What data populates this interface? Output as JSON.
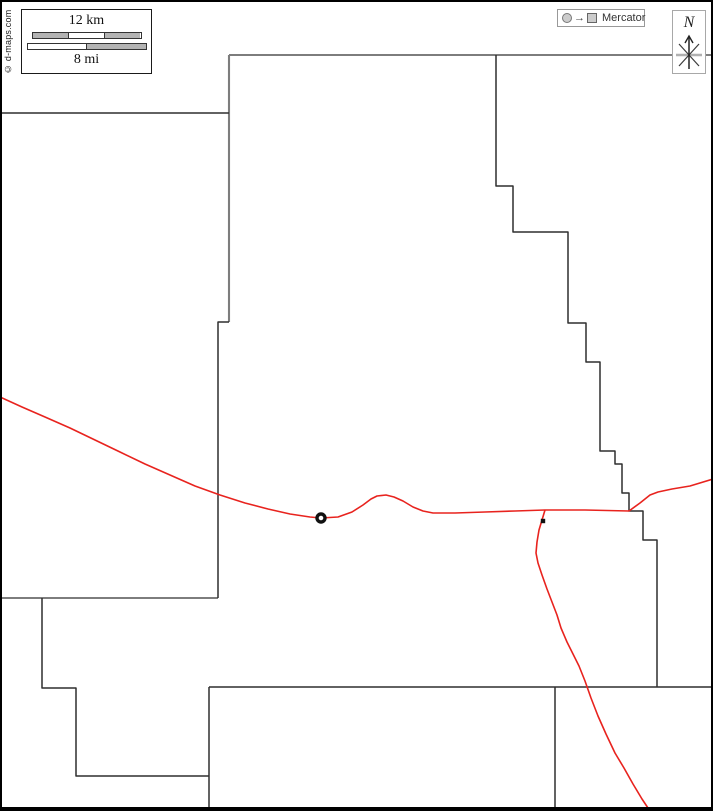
{
  "copyright": {
    "text": "© d-maps.com"
  },
  "scale_box": {
    "km_label": "12 km",
    "mi_label": "8 mi",
    "km_segments": [
      "#b3b3b3",
      "#ffffff",
      "#b3b3b3"
    ],
    "mi_segments": [
      "#ffffff",
      "#b3b3b3"
    ]
  },
  "projection": {
    "label": "Mercator",
    "icons": [
      "sphere-circle-icon",
      "arrow-right-icon",
      "flat-map-square-icon"
    ],
    "arrow_glyph": "→"
  },
  "compass": {
    "north_label": "N",
    "icon": "compass-star-icon"
  },
  "colors": {
    "boundary_dark": "#2f2f2f",
    "boundary_gray": "#7d7d7d",
    "road": "#e8231e",
    "marker": "#111111",
    "frame": "#000000"
  },
  "map": {
    "boundaries_gray": [
      [
        [
          229,
          55
        ],
        [
          713,
          55
        ]
      ],
      [
        [
          229,
          55
        ],
        [
          229,
          322
        ]
      ],
      [
        [
          0,
          598
        ],
        [
          218,
          598
        ]
      ]
    ],
    "boundaries_dark": [
      [
        [
          0,
          113
        ],
        [
          229,
          113
        ]
      ],
      [
        [
          229,
          322
        ],
        [
          218,
          322
        ],
        [
          218,
          598
        ]
      ],
      [
        [
          42,
          598
        ],
        [
          42,
          688
        ],
        [
          76,
          688
        ],
        [
          76,
          776
        ],
        [
          209,
          776
        ]
      ],
      [
        [
          209,
          687
        ],
        [
          209,
          807
        ]
      ],
      [
        [
          209,
          687
        ],
        [
          713,
          687
        ]
      ],
      [
        [
          555,
          687
        ],
        [
          555,
          807
        ]
      ],
      [
        [
          496,
          55
        ],
        [
          496,
          186
        ],
        [
          513,
          186
        ],
        [
          513,
          232
        ],
        [
          568,
          232
        ],
        [
          568,
          323
        ],
        [
          586,
          323
        ],
        [
          586,
          362
        ],
        [
          600,
          362
        ],
        [
          600,
          451
        ],
        [
          615,
          451
        ],
        [
          615,
          464
        ],
        [
          622,
          464
        ],
        [
          622,
          493
        ],
        [
          629,
          493
        ],
        [
          629,
          511
        ],
        [
          643,
          511
        ],
        [
          643,
          540
        ],
        [
          657,
          540
        ],
        [
          657,
          687
        ]
      ]
    ],
    "roads": [
      [
        [
          0,
          397
        ],
        [
          22,
          407
        ],
        [
          45,
          417
        ],
        [
          70,
          428
        ],
        [
          95,
          440
        ],
        [
          120,
          452
        ],
        [
          145,
          464
        ],
        [
          170,
          475
        ],
        [
          195,
          486
        ],
        [
          220,
          495
        ],
        [
          245,
          503
        ],
        [
          268,
          509
        ],
        [
          290,
          514
        ],
        [
          310,
          517
        ],
        [
          321,
          518
        ],
        [
          338,
          517
        ],
        [
          352,
          512
        ],
        [
          363,
          505
        ],
        [
          371,
          499
        ],
        [
          377,
          496
        ],
        [
          386,
          495
        ],
        [
          394,
          497
        ],
        [
          403,
          501
        ],
        [
          413,
          507
        ],
        [
          423,
          511
        ],
        [
          433,
          513
        ],
        [
          455,
          513
        ],
        [
          485,
          512
        ],
        [
          515,
          511
        ],
        [
          545,
          510
        ],
        [
          585,
          510
        ],
        [
          629,
          511
        ]
      ],
      [
        [
          629,
          511
        ],
        [
          640,
          503
        ],
        [
          650,
          495
        ],
        [
          658,
          492
        ],
        [
          672,
          489
        ],
        [
          690,
          486
        ],
        [
          713,
          479
        ]
      ],
      [
        [
          545,
          510
        ],
        [
          542,
          520
        ],
        [
          539,
          530
        ],
        [
          537,
          542
        ],
        [
          536,
          553
        ],
        [
          538,
          563
        ],
        [
          542,
          575
        ],
        [
          547,
          589
        ],
        [
          552,
          602
        ],
        [
          557,
          615
        ],
        [
          561,
          628
        ],
        [
          567,
          642
        ],
        [
          573,
          654
        ],
        [
          579,
          666
        ],
        [
          585,
          681
        ],
        [
          591,
          698
        ],
        [
          598,
          716
        ],
        [
          606,
          734
        ],
        [
          615,
          753
        ],
        [
          624,
          768
        ],
        [
          633,
          784
        ],
        [
          642,
          799
        ],
        [
          648,
          808
        ]
      ]
    ],
    "markers": [
      {
        "type": "ring",
        "name": "town-ring-marker",
        "x": 321,
        "y": 518
      },
      {
        "type": "dot",
        "name": "junction-dot-marker",
        "x": 543,
        "y": 521
      }
    ]
  }
}
